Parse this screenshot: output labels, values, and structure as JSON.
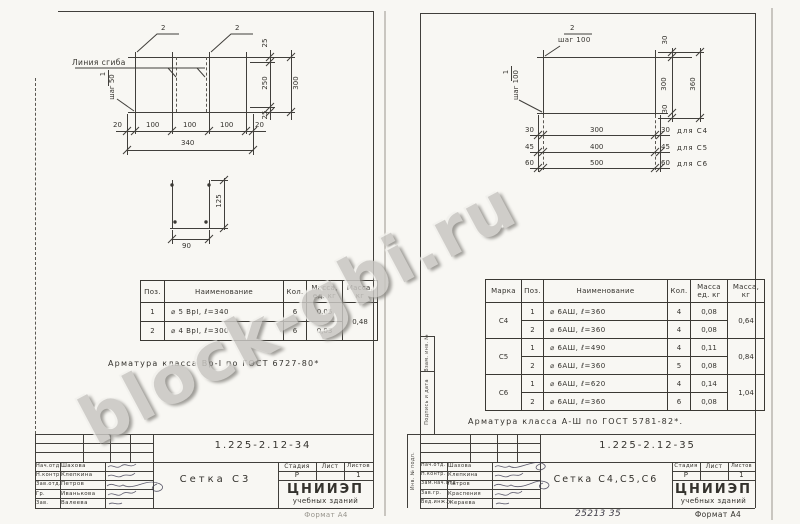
{
  "watermark": {
    "text": "block-gbi.ru"
  },
  "left_page": {
    "mesh": {
      "leader2a": "2",
      "leader2b": "2",
      "bend_line_label": "Линия сгиба",
      "pos1": "1",
      "pitch": "шаг 50",
      "dims_bottom": [
        "20",
        "100",
        "100",
        "100",
        "20"
      ],
      "dim_total": "340",
      "dim_25_top": "25",
      "dim_250": "250",
      "dim_300": "300",
      "dim_25_bot": "25"
    },
    "detail": {
      "dim_125": "125",
      "dim_90": "90"
    },
    "table": {
      "h_pos": "Поз.",
      "h_name": "Наименование",
      "h_qty": "Кол.",
      "h_unit1": "Масса,",
      "h_unit2": "ед. кг",
      "h_mass1": "Масса,",
      "h_mass2": "кг",
      "rows": [
        {
          "pos": "1",
          "name": "⌀ 5 ВрI,  ℓ=340",
          "qty": "6",
          "unit": "0,05"
        },
        {
          "pos": "2",
          "name": "⌀ 4 ВрI,  ℓ=300",
          "qty": "6",
          "unit": "0,03"
        }
      ],
      "total_mass": "0,48"
    },
    "note": "Арматура класса Вр-I по ГОСТ 6727-80*",
    "title_block": {
      "doc_number": "1.225-2.12-34",
      "title": "Сетка С3",
      "h_stage": "Стадия",
      "h_sheet": "Лист",
      "h_sheets": "Листов",
      "stage": "Р",
      "sheets": "1",
      "org1": "ЦНИИЭП",
      "org2": "учебных зданий",
      "signatures": [
        {
          "role": "Нач.отд.",
          "name": "Шахова"
        },
        {
          "role": "Н.контр.",
          "name": "Клепкина"
        },
        {
          "role": "Зав.отд.",
          "name": "Петров"
        },
        {
          "role": "Гр.",
          "name": "Иванькова"
        },
        {
          "role": "Зав.",
          "name": "Валеева"
        }
      ]
    },
    "format": "Формат А4"
  },
  "right_page": {
    "stamp_labels": {
      "vzam": "Взам. инв. №",
      "podpis": "Подпись и дата",
      "inv": "Инв. № подл."
    },
    "mesh": {
      "pos2": "2",
      "pitch2": "шаг 100",
      "pos1": "1",
      "pitch1": "шаг 100",
      "dim_30_top": "30",
      "dim_300": "300",
      "dim_360": "360",
      "dim_30_bot": "30",
      "rows": [
        {
          "left": "30",
          "mid": "300",
          "right": "30",
          "label": "для С4"
        },
        {
          "left": "45",
          "mid": "400",
          "right": "45",
          "label": "для С5"
        },
        {
          "left": "60",
          "mid": "500",
          "right": "60",
          "label": "для С6"
        }
      ]
    },
    "table": {
      "h_mark": "Марка",
      "h_pos": "Поз.",
      "h_name": "Наименование",
      "h_qty": "Кол.",
      "h_unit1": "Масса",
      "h_unit2": "ед. кг",
      "h_mass1": "Масса,",
      "h_mass2": "кг",
      "groups": [
        {
          "mark": "С4",
          "total": "0,64",
          "rows": [
            {
              "pos": "1",
              "name": "⌀ 6АШ,  ℓ=360",
              "qty": "4",
              "unit": "0,08"
            },
            {
              "pos": "2",
              "name": "⌀ 6АШ,  ℓ=360",
              "qty": "4",
              "unit": "0,08"
            }
          ]
        },
        {
          "mark": "С5",
          "total": "0,84",
          "rows": [
            {
              "pos": "1",
              "name": "⌀ 6АШ,  ℓ=490",
              "qty": "4",
              "unit": "0,11"
            },
            {
              "pos": "2",
              "name": "⌀ 6АШ,  ℓ=360",
              "qty": "5",
              "unit": "0,08"
            }
          ]
        },
        {
          "mark": "С6",
          "total": "1,04",
          "rows": [
            {
              "pos": "1",
              "name": "⌀ 6АШ,  ℓ=620",
              "qty": "4",
              "unit": "0,14"
            },
            {
              "pos": "2",
              "name": "⌀ 6АШ,  ℓ=360",
              "qty": "6",
              "unit": "0,08"
            }
          ]
        }
      ]
    },
    "note": "Арматура класса А-Ш по ГОСТ 5781-82*.",
    "title_block": {
      "doc_number": "1.225-2.12-35",
      "title": "Сетка С4,С5,С6",
      "h_stage": "Стадия",
      "h_sheet": "Лист",
      "h_sheets": "Листов",
      "stage": "Р",
      "sheets": "1",
      "org1": "ЦНИИЭП",
      "org2": "учебных зданий",
      "signatures": [
        {
          "role": "Нач.отд.",
          "name": "Шахова"
        },
        {
          "role": "Н.контр.",
          "name": "Клепкина"
        },
        {
          "role": "Зам.нач.отд",
          "name": "Петров"
        },
        {
          "role": "Зав.гр.",
          "name": "Краспения"
        },
        {
          "role": "Вед.инж.",
          "name": "Жераева"
        }
      ],
      "handwritten": "25213   35"
    },
    "format": "Формат А4"
  }
}
